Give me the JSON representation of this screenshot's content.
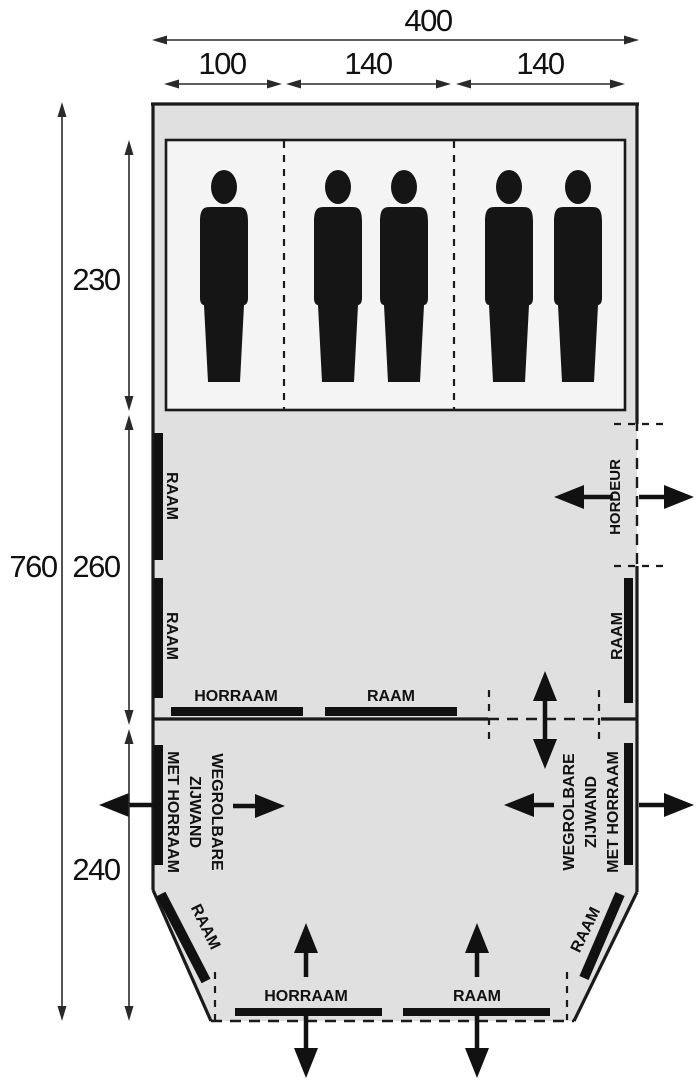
{
  "diagram": {
    "type": "tent-floorplan",
    "colors": {
      "background": "#ffffff",
      "floor": "#e0e0e0",
      "sleeping_area": "#f4f4f4",
      "ink": "#1a1a1a"
    },
    "dimensions": {
      "total_width": "400",
      "compartment_widths": [
        "100",
        "140",
        "140"
      ],
      "total_depth": "760",
      "depth_segments": [
        "230",
        "260",
        "240"
      ]
    },
    "labels": {
      "window": "RAAM",
      "screen_window": "HORRAAM",
      "screen_door": "HORDEUR",
      "rollaway_sidewall_line1": "WEGROLBARE",
      "rollaway_sidewall_line2": "ZIJWAND",
      "rollaway_sidewall_line3": "MET HORRAAM"
    },
    "sleeping_compartments": 3,
    "person_count": 5
  }
}
